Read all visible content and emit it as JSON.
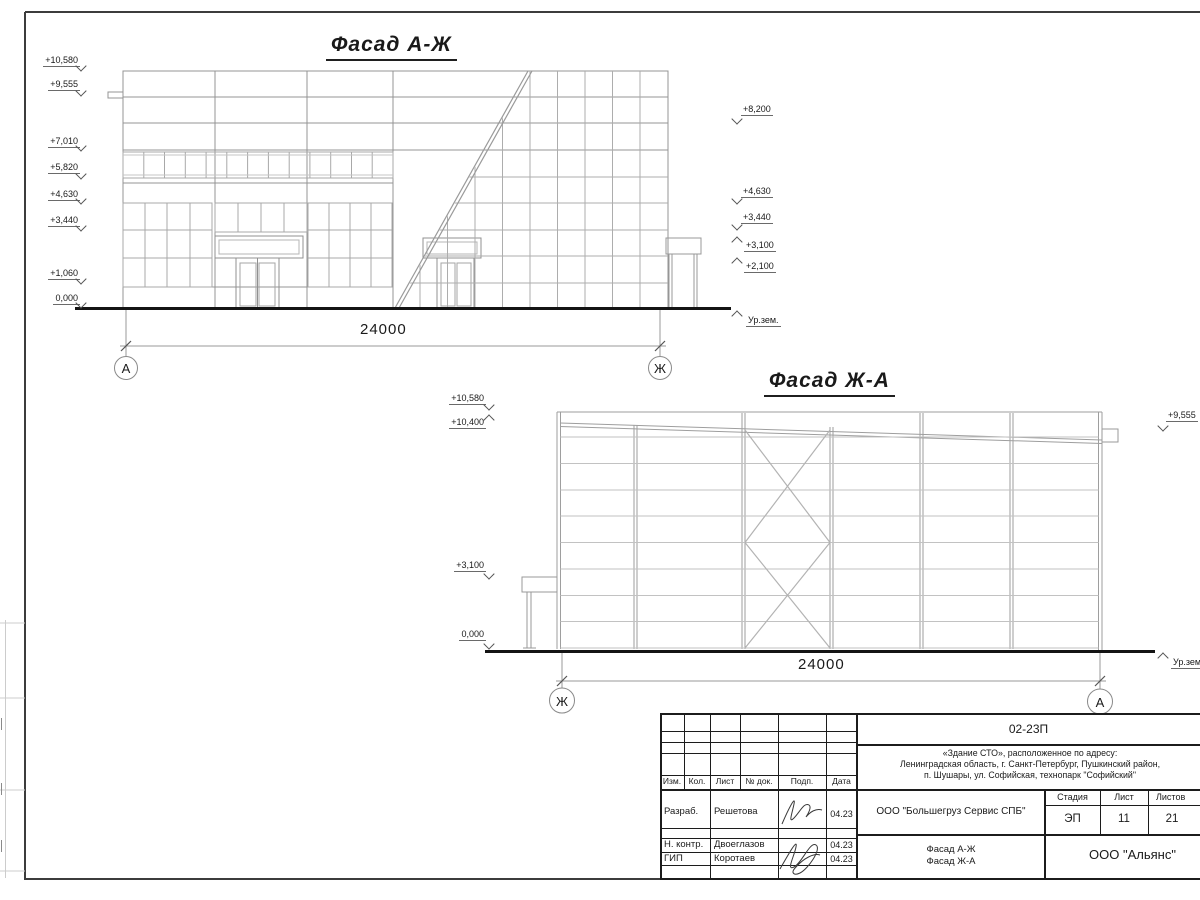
{
  "facade1": {
    "title": "Фасад А-Ж",
    "dim": "24000",
    "axis_left": "А",
    "axis_right": "Ж",
    "marks_left": [
      "+10,580",
      "+9,555",
      "+7,010",
      "+5,820",
      "+4,630",
      "+3,440",
      "+1,060",
      "0,000"
    ],
    "marks_right": [
      "+8,200",
      "+4,630",
      "+3,440",
      "+3,100",
      "+2,100"
    ],
    "ground_label": "Ур.зем."
  },
  "facade2": {
    "title": "Фасад Ж-А",
    "dim": "24000",
    "axis_left": "Ж",
    "axis_right": "А",
    "marks_left": [
      "+10,580",
      "+10,400",
      "+3,100",
      "0,000"
    ],
    "marks_right": [
      "+9,555"
    ],
    "ground_label": "Ур.зем."
  },
  "titleblock": {
    "doc_number": "02-23П",
    "address_line1": "«Здание СТО», расположенное по адресу:",
    "address_line2": "Ленинградская область, г. Санкт-Петербург, Пушкинский район,",
    "address_line3": "п. Шушары, ул. Софийская, технопарк \"Софийский\"",
    "client": "ООО \"Большегруз Сервис СПБ\"",
    "sheet_title_line1": "Фасад А-Ж",
    "sheet_title_line2": "Фасад Ж-А",
    "company": "ООО \"Альянс\"",
    "stage_label": "Стадия",
    "sheet_label": "Лист",
    "sheets_label": "Листов",
    "stage": "ЭП",
    "sheet_no": "11",
    "sheets_total": "21",
    "cols": {
      "izm": "Изм.",
      "kol": "Кол.",
      "list": "Лист",
      "doc": "№ док.",
      "podp": "Подп.",
      "data": "Дата"
    },
    "rows": [
      {
        "role": "Разраб.",
        "name": "Решетова",
        "date": "04.23"
      },
      {
        "role": "Н. контр.",
        "name": "Двоеглазов",
        "date": "04.23"
      },
      {
        "role": "ГИП",
        "name": "Коротаев",
        "date": "04.23"
      }
    ]
  }
}
